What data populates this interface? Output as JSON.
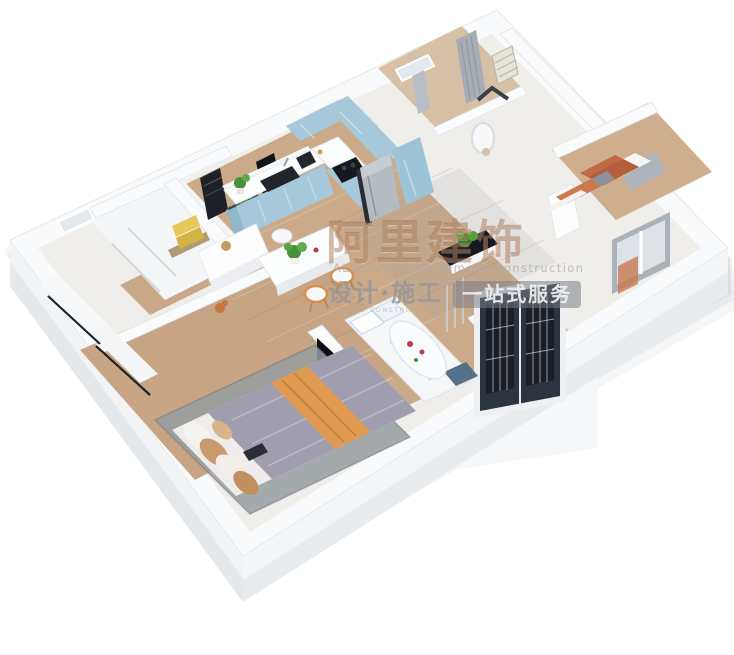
{
  "watermark": {
    "brand_cn": "阿里建饰",
    "brand_en": "ALIECUS Development Construction",
    "services_cn": "设计·施工",
    "services_sub_en": "ALIECUS CONSTRUCTION",
    "badge": "一站式服务"
  },
  "palette": {
    "cabinet_blue": "#a6c8da",
    "wood_floor": "#cbaa8a",
    "terracotta_bedding": "#c06a45",
    "throw_orange": "#e09a50",
    "duvet_gray": "#a09eae",
    "entry_door_navy": "#2c3440",
    "wall_white": "#f8f9fa",
    "watermark_bronze": "rgba(146,86,42,0.40)"
  }
}
